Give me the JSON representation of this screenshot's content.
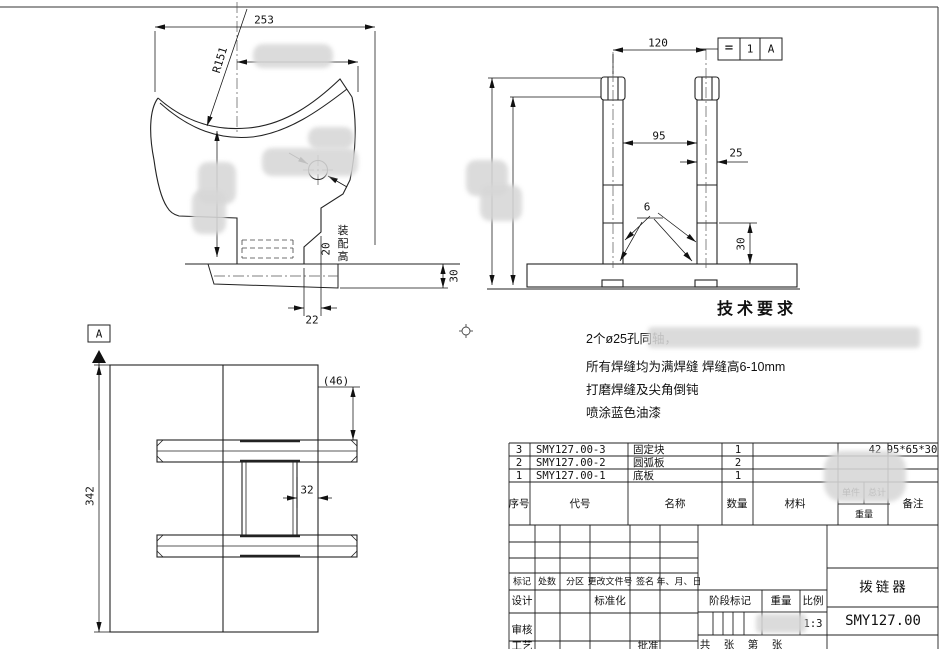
{
  "views": {
    "left": {
      "w": "253",
      "r": "R151",
      "step": "22",
      "flange": "30",
      "asm": "20",
      "asm_label": "装配高"
    },
    "right": {
      "span": "120",
      "inner": "95",
      "post": "25",
      "weld": "6",
      "h": "30",
      "fr_sym": "=",
      "fr_val": "1",
      "fr_datum": "A"
    },
    "top": {
      "label": "A",
      "len": "342",
      "ref": "(46)",
      "gap": "32"
    }
  },
  "tech": {
    "title": "技术要求",
    "lines": [
      "2个ø25孔同轴，",
      "所有焊缝均为满焊缝 焊缝高6-10mm",
      "打磨焊缝及尖角倒钝",
      "喷涂蓝色油漆"
    ]
  },
  "parts": {
    "headers": {
      "seq": "序号",
      "code": "代号",
      "name": "名称",
      "qty": "数量",
      "material": "材料",
      "unit": "单件",
      "total": "总计",
      "weight": "重量",
      "remark": "备注"
    },
    "rows": [
      {
        "seq": "3",
        "code": "SMY127.00-3",
        "name": "固定块",
        "qty": "1",
        "total": "42",
        "remark": "95*65*30"
      },
      {
        "seq": "2",
        "code": "SMY127.00-2",
        "name": "圆弧板",
        "qty": "2",
        "total": "",
        "remark": ""
      },
      {
        "seq": "1",
        "code": "SMY127.00-1",
        "name": "底板",
        "qty": "1",
        "total": "",
        "remark": ""
      }
    ]
  },
  "tb": {
    "mark": "标记",
    "count": "处数",
    "zone": "分区",
    "doc_no": "更改文件号",
    "sign": "签名",
    "date": "年、月、日",
    "design": "设计",
    "standard": "标准化",
    "check": "审核",
    "process": "工艺",
    "approve": "批准",
    "stage": "阶段标记",
    "weight": "重量",
    "scale": "比例",
    "scale_val": "1:3",
    "total": "共",
    "sheet": "张",
    "no": "第",
    "sheet2": "张",
    "part_name": "拨链器",
    "drawing_no": "SMY127.00"
  },
  "colors": {
    "line": "#222222",
    "blur_patch": "#d7d7d7",
    "paper": "#ffffff"
  }
}
